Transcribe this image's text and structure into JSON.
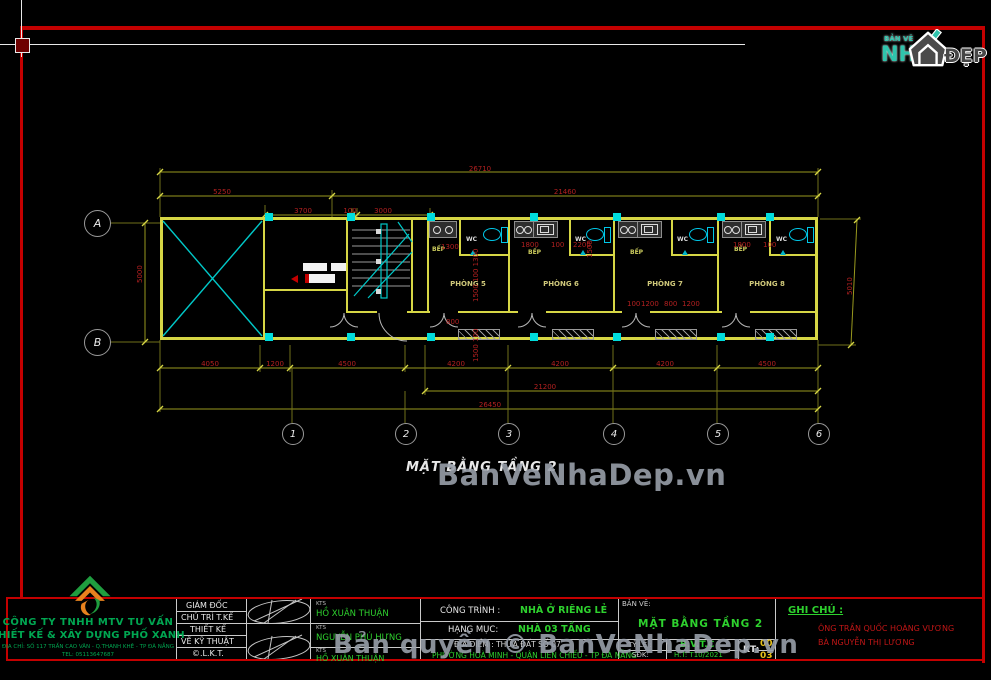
{
  "brand": {
    "top": "BẢN VẼ",
    "name": "NH",
    "suffix": "ĐẸP"
  },
  "watermarks": {
    "plan": "BanVeNhaDep.vn",
    "copyright": "Bản quyền © BanVeNhaDep.vn"
  },
  "plan": {
    "title": "MẶT BẰNG TẦNG 2",
    "kitchen": "BẾP",
    "wc": "WC",
    "rooms": [
      "PHÒNG 5",
      "PHÒNG 6",
      "PHÒNG 7",
      "PHÒNG 8"
    ],
    "grid_cols": [
      "1",
      "2",
      "3",
      "4",
      "5",
      "6"
    ],
    "grid_rows": [
      "A",
      "B"
    ],
    "dims": {
      "total_top": "26710",
      "left_top": "5250",
      "right_top": "21460",
      "sub_top": [
        "3700",
        "100",
        "3000"
      ],
      "chain_bottom": [
        "4050",
        "1200",
        "4500",
        "4200",
        "4200",
        "4200",
        "4500"
      ],
      "span_bottom": "21200",
      "total_bottom": "26450",
      "height_left": "5000",
      "height_right": "5010",
      "k1300": "1300",
      "k1800": "1800",
      "k100": "100",
      "k2200": "2200",
      "d100": "100",
      "d1200": "1200",
      "d800": "800",
      "s_stack": "1500  100  1300",
      "s_stack2": "1500  100",
      "s1500": "1500",
      "v800": "800"
    }
  },
  "titleblock": {
    "company": {
      "line1": "CÔNG TY TNHH MTV TƯ VẤN",
      "line2": "THIẾT KẾ & XÂY DỰNG PHỐ XANH",
      "address": "ĐỊA CHỈ: SỐ 117 TRẦN CAO VÂN - Q.THANH KHÊ - TP ĐÀ NẴNG",
      "tel": "TEL: 05113647687"
    },
    "roles": [
      "GIÁM ĐỐC",
      "CHỦ TRÌ T.KẾ",
      "THIẾT KẾ",
      "VẼ KỸ THUẬT",
      "©.L.K.T."
    ],
    "people": [
      {
        "title": "KTS",
        "name": "HỒ XUÂN THUẬN"
      },
      {
        "title": "KTS",
        "name": "NGUYỄN PHÚ HƯNG"
      },
      {
        "title": "KTS",
        "name": "HỒ XUÂN THUẬN"
      }
    ],
    "project_label": "CÔNG TRÌNH :",
    "project": "NHÀ Ở RIÊNG LẺ",
    "category_label": "HẠNG MỤC:",
    "category": "NHÀ 03 TẦNG",
    "location_label": "ĐỊA ĐIỂM : THỬA ĐẤT SỐ 07",
    "address2": "PHƯỜNG HOÀ MINH - QUẬN LIÊN CHIẾU - TP ĐÀ NẴNG",
    "sheet_label": "BẢN VẼ:",
    "sheet_title": "MẶT BẰNG TẦNG 2",
    "scale_label": "TỶ LỆ :",
    "sdk_label": "SĐK:",
    "stage": "B.V.T.C",
    "date": "H.T: T10/2021",
    "kt_label": "KT:",
    "kt_num": "00",
    "kt_den": "03",
    "note_label": "GHI CHÚ :",
    "notes": [
      "ÔNG  TRẦN QUỐC HOÀNG VƯƠNG",
      "BÀ  NGUYỄN THỊ LƯƠNG"
    ]
  }
}
